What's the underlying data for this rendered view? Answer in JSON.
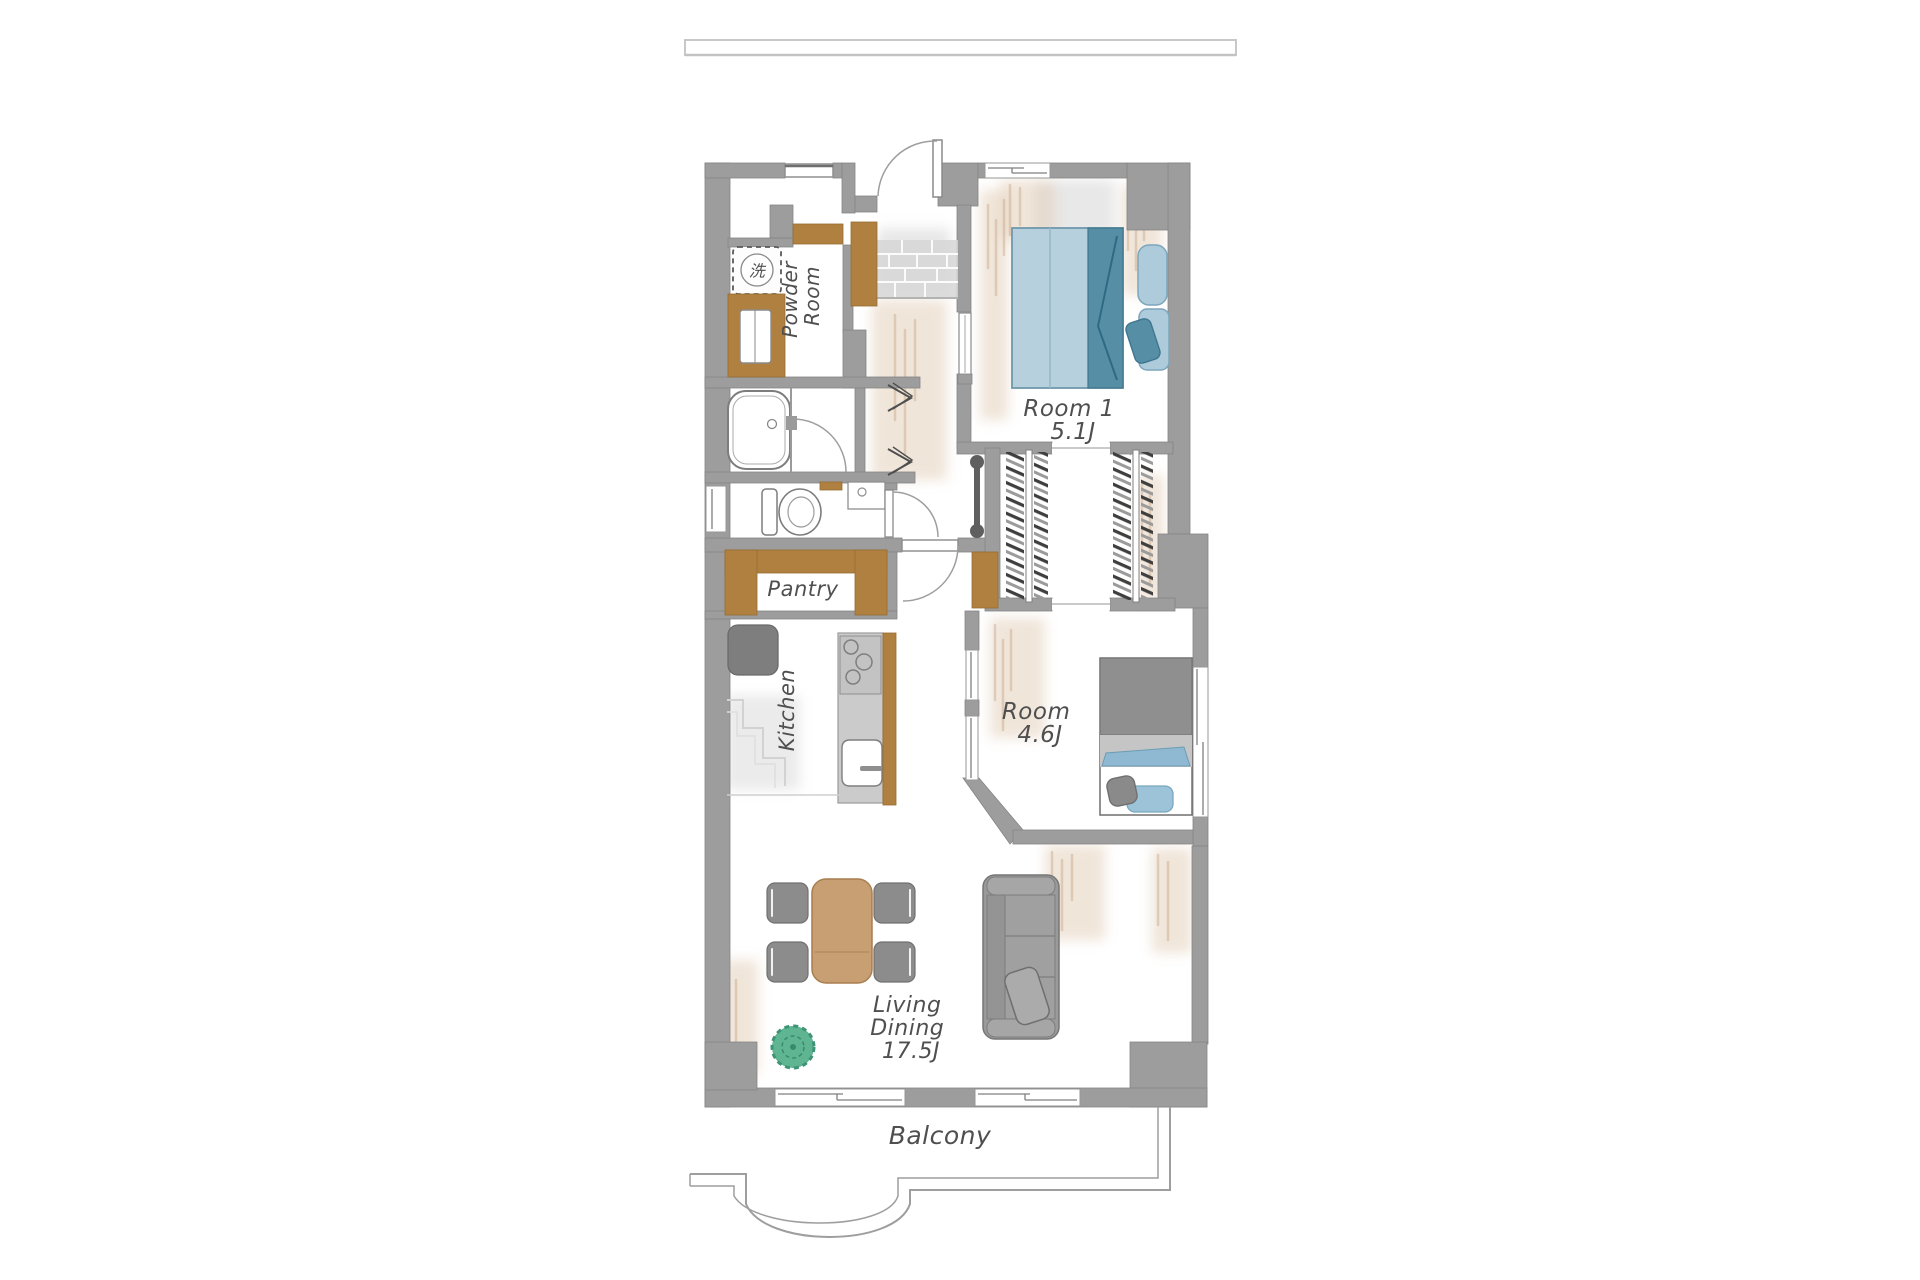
{
  "floor_plan": {
    "rooms": {
      "powder_room": {
        "label_line1": "Powder",
        "label_line2": "Room"
      },
      "room1": {
        "name": "Room 1",
        "size": "5.1J"
      },
      "room2": {
        "name": "Room",
        "size": "4.6J"
      },
      "living_dining": {
        "label_line1": "Living",
        "label_line2": "Dining",
        "size": "17.5J"
      },
      "pantry": {
        "label": "Pantry"
      },
      "kitchen": {
        "label": "Kitchen"
      },
      "balcony": {
        "label": "Balcony"
      }
    },
    "symbols": {
      "washing_machine": "洗"
    },
    "colors": {
      "wall": "#9d9d9d",
      "wood": "#b08040",
      "bed_blue_light": "#b7d0de",
      "bed_blue_dark": "#568ea6",
      "furniture_gray": "#9a9a9a",
      "table_wood": "#c79f72",
      "plant_green": "#5fb592",
      "label_text": "#4f4f4f",
      "shading_beige": "#e2cbb4"
    }
  }
}
